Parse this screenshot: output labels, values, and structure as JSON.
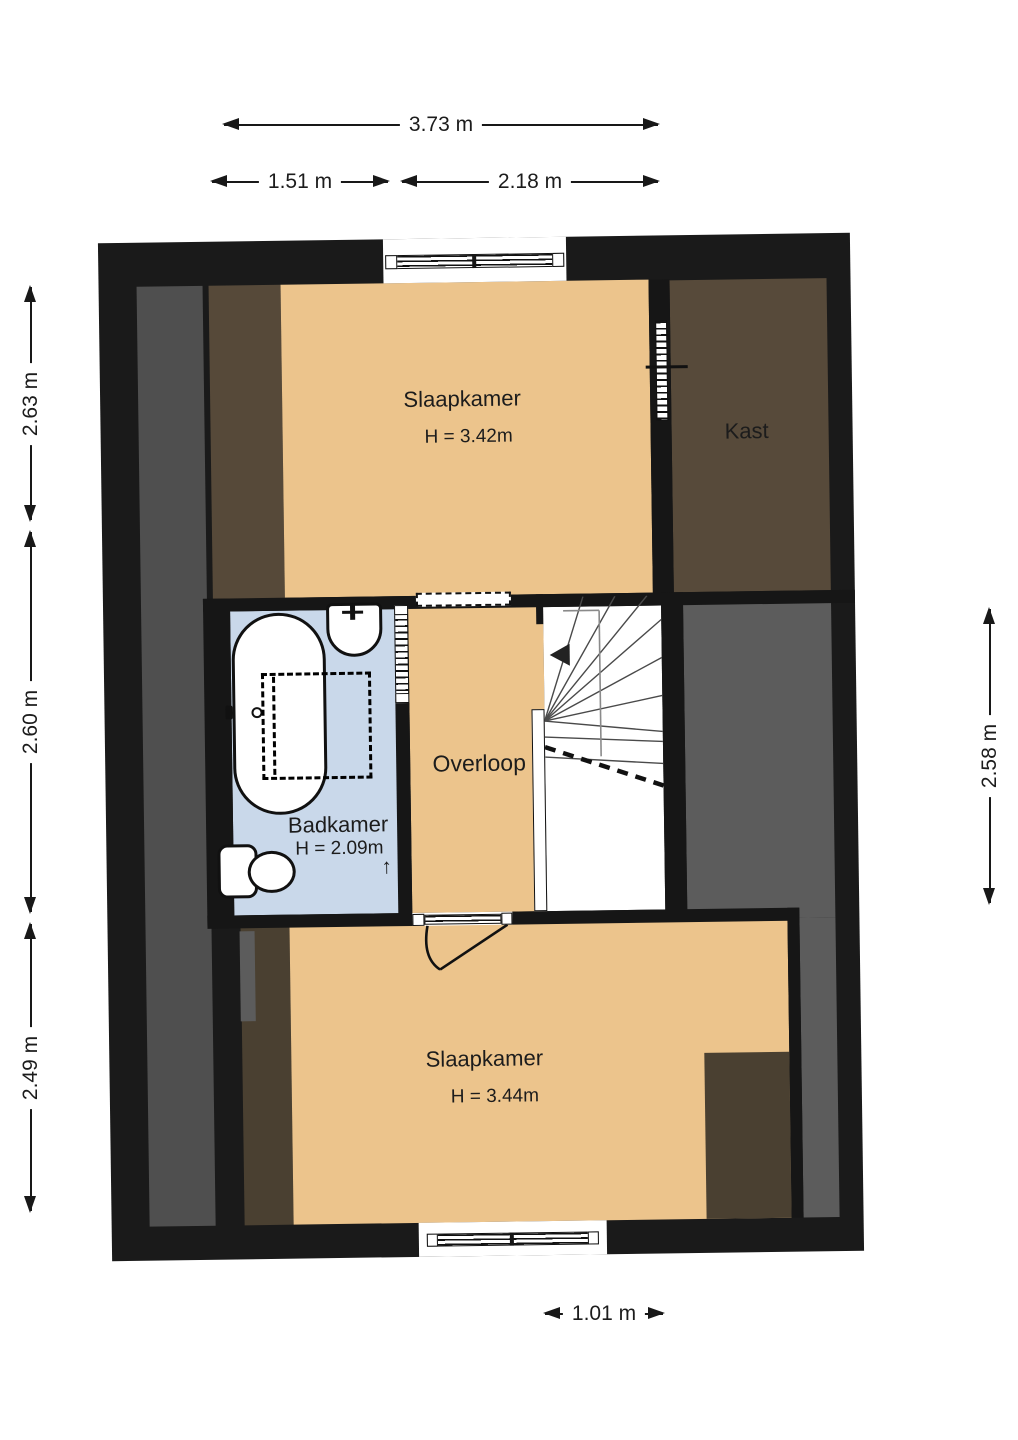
{
  "plan_type": "floorplan-upper-floor",
  "rooms": {
    "slaapkamer_top": {
      "label": "Slaapkamer",
      "height": "H = 3.42m"
    },
    "kast": {
      "label": "Kast"
    },
    "badkamer": {
      "label": "Badkamer",
      "height": "H = 2.09m"
    },
    "overloop": {
      "label": "Overloop"
    },
    "slaapkamer_bottom": {
      "label": "Slaapkamer",
      "height": "H = 3.44m"
    }
  },
  "dimensions": {
    "top_total": "3.73 m",
    "top_left": "1.51 m",
    "top_right": "2.18 m",
    "left_top": "2.63 m",
    "left_middle": "2.60 m",
    "left_bottom": "2.49 m",
    "right_middle": "2.58 m",
    "bottom": "1.01 m"
  },
  "symbols": {
    "badkamer_direction_arrow": "↑"
  },
  "fixtures": [
    "bathtub",
    "washbasin",
    "toilet",
    "shower-dashed-outline",
    "winder-stairs",
    "door-swing",
    "window-top",
    "window-bottom",
    "sliding-door-kast",
    "sliding-door-badkamer"
  ],
  "colors": {
    "canvas": "#ffffff",
    "wall": "#1a1a1a",
    "floor_orange": "#ecc48c",
    "bathroom_blue": "#c9d8ea",
    "kast_brown": "#574a3a",
    "sloped_brown": "#4a4031",
    "sloped_gray_left": "#4f4f4f",
    "sloped_gray_right": "#5c5c5c"
  }
}
